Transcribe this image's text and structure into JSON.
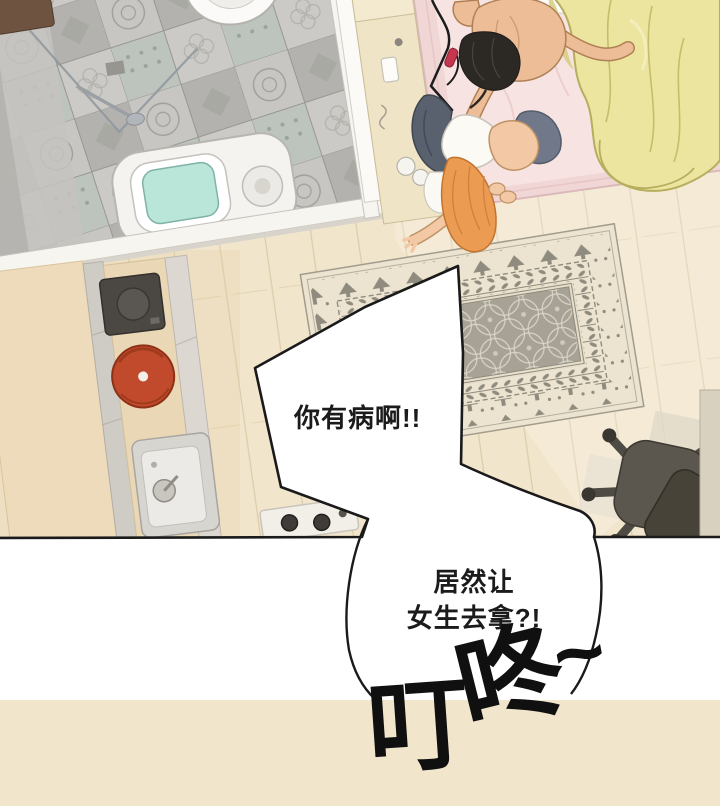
{
  "panel": {
    "type": "webtoon-comic-panel",
    "view": "top-down room scene"
  },
  "bubbles": {
    "bubble1": {
      "text": "你有病啊!!"
    },
    "bubble2": {
      "line1": "居然让",
      "line2": "女生去拿?!"
    }
  },
  "sfx": {
    "text": "叮咚~",
    "chars": [
      "叮",
      "咚",
      "~"
    ]
  },
  "scene": {
    "colors": {
      "floor_wood": "#f1e5cb",
      "floor_line": "#dccdaa",
      "tile_light": "#c7c6c2",
      "tile_dark": "#b3b2ae",
      "tile_green": "#bdc4be",
      "bed_frame": "#f1d6d6",
      "bed_sheet": "#f7e4e2",
      "blanket_yellow": "#ebe59f",
      "rug_base": "#ece4d0",
      "rug_field": "#a7a295",
      "rug_motif": "#8f8b7e",
      "man_hair": "#2c2824",
      "man_skin": "#edbd97",
      "girl_hair": "#eb9c52",
      "girl_skin": "#f2c9a4",
      "jeans_navy": "#59616f",
      "pot_red": "#c14a2c",
      "toilet_screen": "#b9e6d9",
      "chair_gray": "#5b564e",
      "bubble_fill": "#ffffff",
      "bubble_outline": "#1a1a1a"
    }
  }
}
